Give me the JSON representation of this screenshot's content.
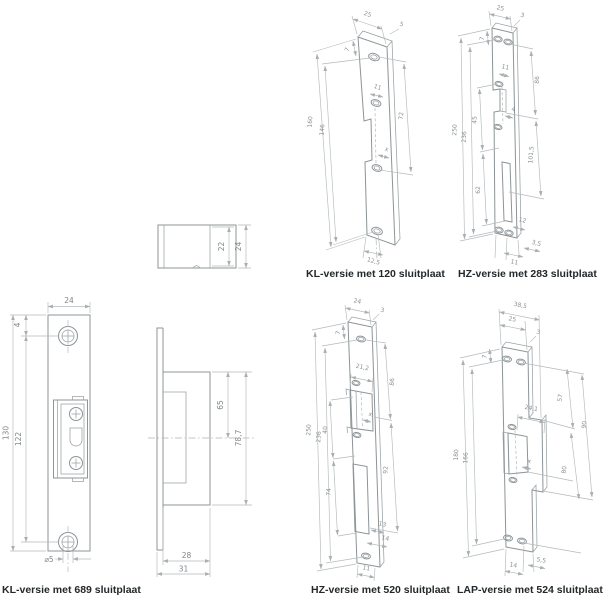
{
  "sheet": {
    "labels": {
      "kl689": "KL-versie met 689 sluitplaat",
      "kl120": "KL-versie met 120 sluitplaat",
      "hz283": "HZ-versie met 283 sluitplaat",
      "hz520": "HZ-versie met 520 sluitplaat",
      "lap524": "LAP-versie met 524 sluitplaat"
    }
  },
  "front": {
    "width": "24",
    "top_offset": "4",
    "length": "130",
    "hole_spacing": "122",
    "hole_dia": "⌀5"
  },
  "topview": {
    "inner": "22",
    "outer": "24"
  },
  "sideview": {
    "depth_upper": "65",
    "depth_total": "78,7",
    "body_width": "28",
    "total_width": "31"
  },
  "kl120": {
    "width": "25",
    "thickness": "5",
    "top_offset": "7",
    "latch": "11",
    "length": "160",
    "hole_spacing": "146",
    "right": "72",
    "x": "x",
    "bottom": "12,5"
  },
  "hz283": {
    "width": "25",
    "thickness": "3",
    "top_offset": "7",
    "latch": "11",
    "length": "250",
    "hole_spacing": "236",
    "left_a": "45",
    "left_b": "62",
    "right_a": "86",
    "right_b": "101,5",
    "mid": "4",
    "bottom_a": "12",
    "bottom_b": "3,5",
    "bottom_c": "11"
  },
  "hz520": {
    "width": "24",
    "thickness": "3",
    "top_offset": "7",
    "latch": "21,2",
    "length": "250",
    "hole_spacing": "236",
    "left_a": "40",
    "left_b": "74",
    "right_a": "86",
    "right_b": "92",
    "x": "x",
    "bottom_a": "13",
    "bottom_b": "14",
    "bottom_c": "11"
  },
  "lap524": {
    "lip_width": "38,5",
    "width": "25",
    "thickness": "3",
    "top_offset": "7",
    "length": "180",
    "hole_spacing": "166",
    "latch": "24,1",
    "right_a": "57",
    "right_b": "90",
    "right_c": "80",
    "x": "x",
    "bottom_a": "5,5",
    "bottom_b": "14"
  }
}
